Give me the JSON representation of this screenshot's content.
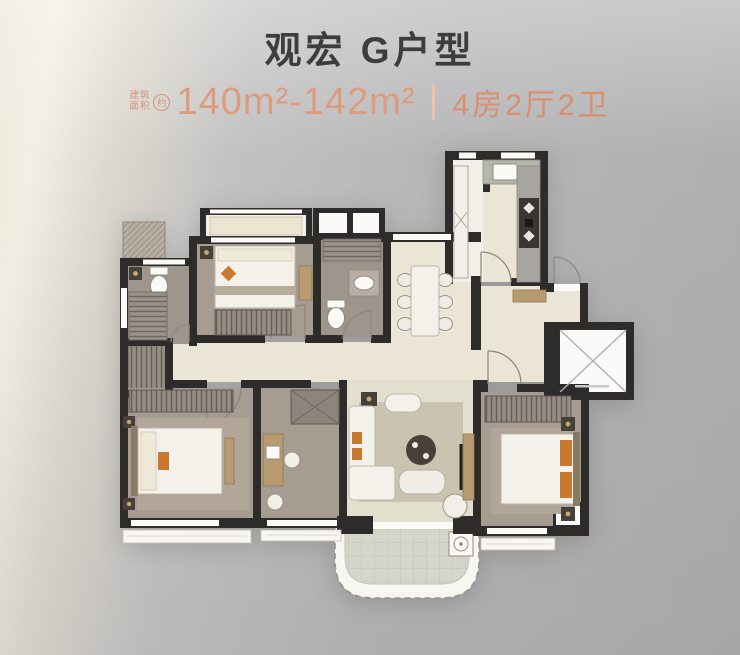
{
  "poster": {
    "title": "观宏 G户型",
    "specs": {
      "area_label_line1": "建筑",
      "area_label_line2": "面积",
      "area_approx_badge": "约",
      "area_value": "140m²-142m²",
      "rooms_value": "4房2厅2卫"
    },
    "colors": {
      "accent_orange": "#dd9c80",
      "title_gray": "#3e3d3b",
      "wall_dark": "#2e2c2a",
      "floor_cream": "#eae5d5",
      "floor_taupe": "#a79c91"
    }
  }
}
